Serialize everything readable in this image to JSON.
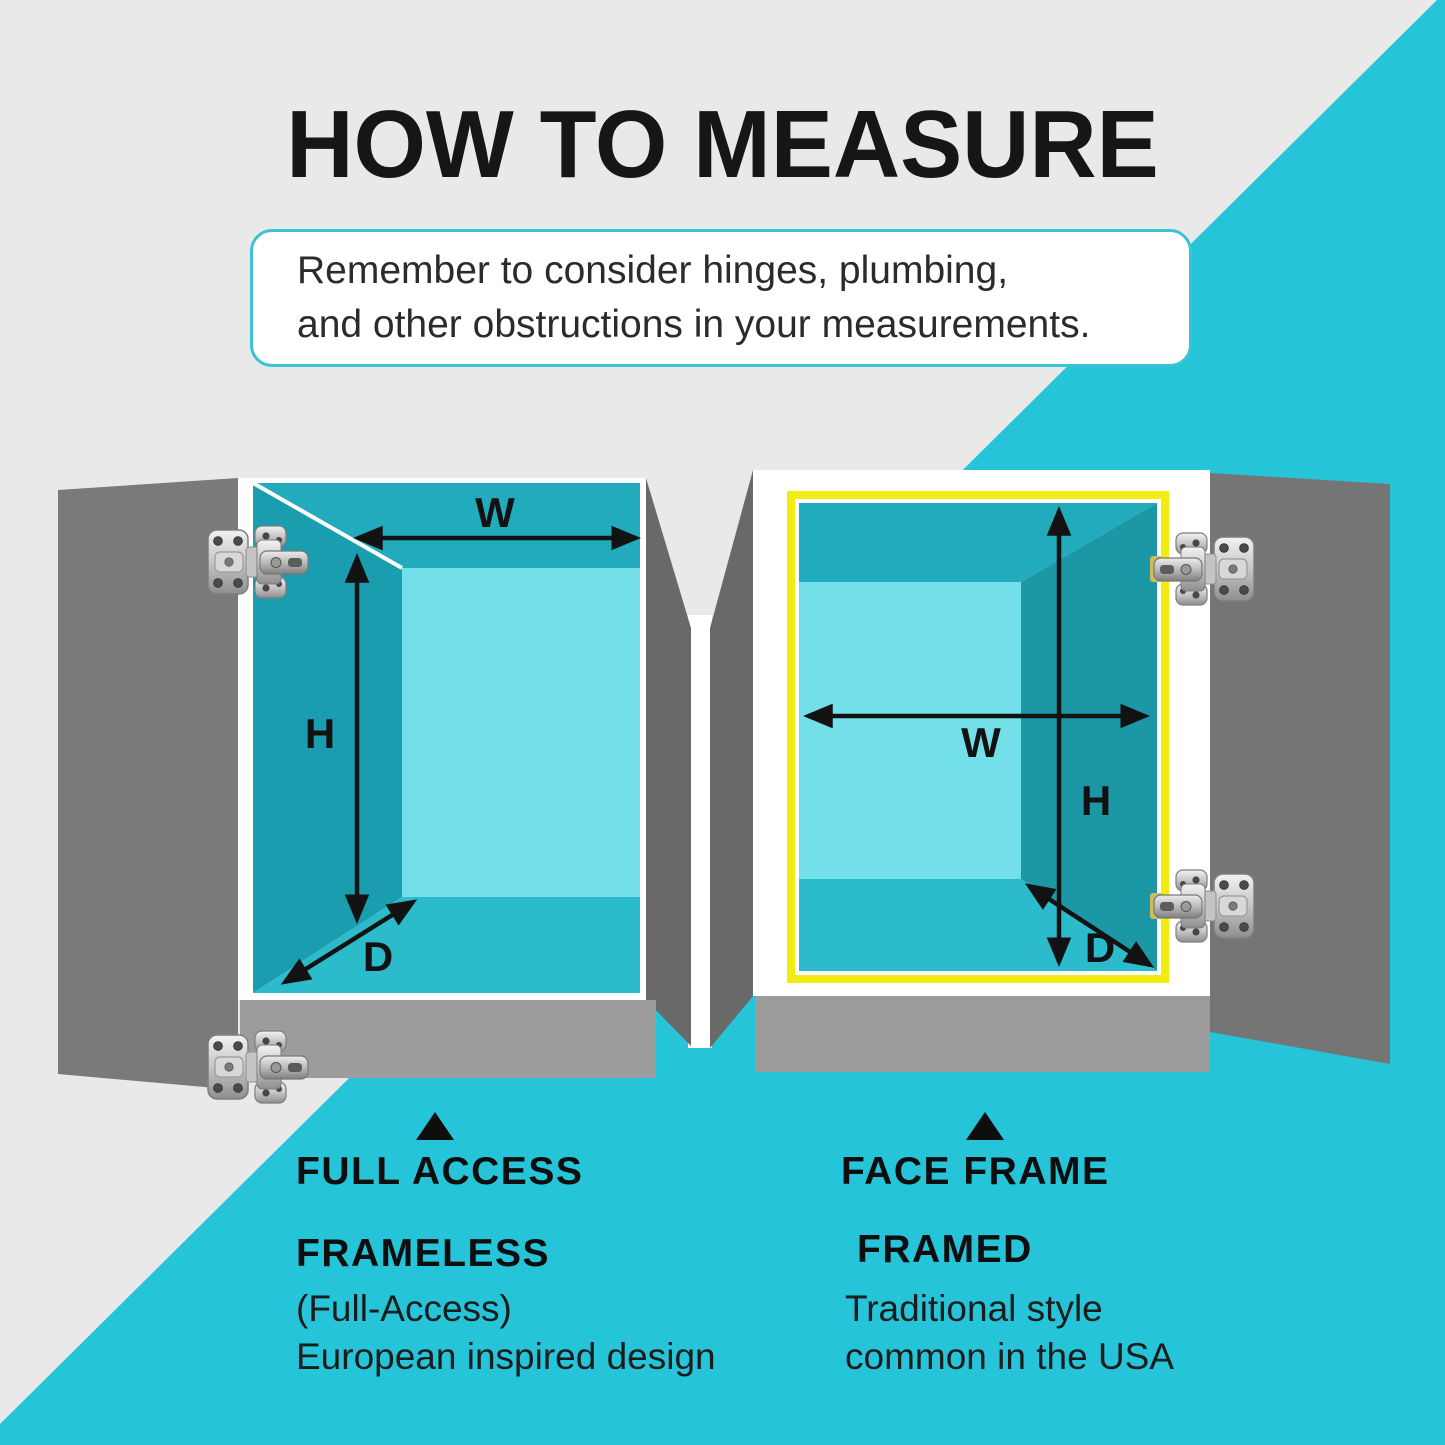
{
  "title": "HOW TO MEASURE",
  "note": {
    "line1": "Remember to consider hinges, plumbing,",
    "line2": "and other obstructions in your measurements."
  },
  "left_cabinet": {
    "pointer_icon": "triangle-up",
    "hinge_icon": "concealed-hinge",
    "heading": "FULL ACCESS",
    "subheading": "FRAMELESS",
    "detail_line1": "(Full-Access)",
    "detail_line2": "European inspired design",
    "dims": {
      "w": "W",
      "h": "H",
      "d": "D"
    }
  },
  "right_cabinet": {
    "pointer_icon": "triangle-up",
    "hinge_icon": "concealed-hinge",
    "heading": "FACE FRAME",
    "subheading": "FRAMED",
    "detail_line1": "Traditional style",
    "detail_line2": "common in the USA",
    "dims": {
      "w": "W",
      "h": "H",
      "d": "D"
    }
  },
  "colors": {
    "background_gray": "#E9E9EA",
    "accent_teal_band": "#25C4D8",
    "door_gray": "#7A7A7A",
    "side_gray": "#696969",
    "base_gray": "#9C9C9C",
    "interior_top_teal": "#21ABBC",
    "interior_wall_teal": "#1A9DAE",
    "interior_wall_dark_teal": "#1C97A5",
    "interior_floor_teal": "#2CBBCA",
    "interior_back_cyan": "#73DFE9",
    "face_frame_yellow": "#F2EC11",
    "note_border_teal": "#3CC3D3",
    "text_black": "#161616"
  }
}
